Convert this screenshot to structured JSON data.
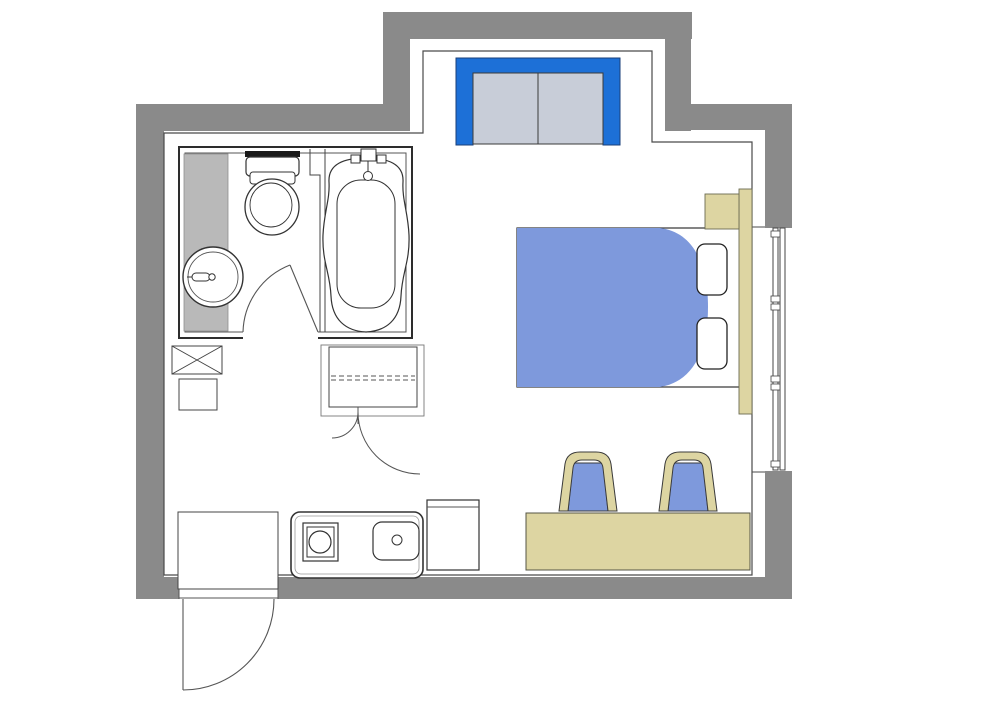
{
  "floorplan": {
    "type": "hotel-studio-room-floor-plan",
    "colors": {
      "background": "#ffffff",
      "wall": "#8a8a8a",
      "line": "#3a3a3a",
      "accent_blue": "#1d70d7",
      "sliding_panel_gray": "#c8cdd8",
      "furniture_blue": "#7e99dc",
      "wood_tan": "#ddd5a2",
      "vanity_gray": "#b9b9b9",
      "fixture_dark": "#1a1a1a",
      "fixture_white": "#ffffff"
    },
    "areas": [
      {
        "name": "closet-alcove",
        "fixtures": [
          "sliding-door-closet"
        ]
      },
      {
        "name": "bathroom",
        "fixtures": [
          "toilet",
          "bathtub",
          "tub-faucet",
          "washbasin",
          "basin-faucet",
          "vanity-counter",
          "bathroom-swing-door",
          "partition-wall"
        ]
      },
      {
        "name": "entry-kitchenette",
        "fixtures": [
          "duct-shaft",
          "storage-box",
          "wardrobe-with-shelf",
          "wardrobe-double-doors",
          "entry-mat",
          "entry-swing-door",
          "kitchen-counter",
          "single-burner-stove",
          "kitchen-sink",
          "side-cabinet"
        ]
      },
      {
        "name": "sleeping-area",
        "fixtures": [
          "double-bed",
          "blanket",
          "pillow-left",
          "pillow-right",
          "headboard",
          "nightstand",
          "desk",
          "desk-chair-1",
          "desk-chair-2",
          "sliding-window"
        ]
      }
    ]
  }
}
